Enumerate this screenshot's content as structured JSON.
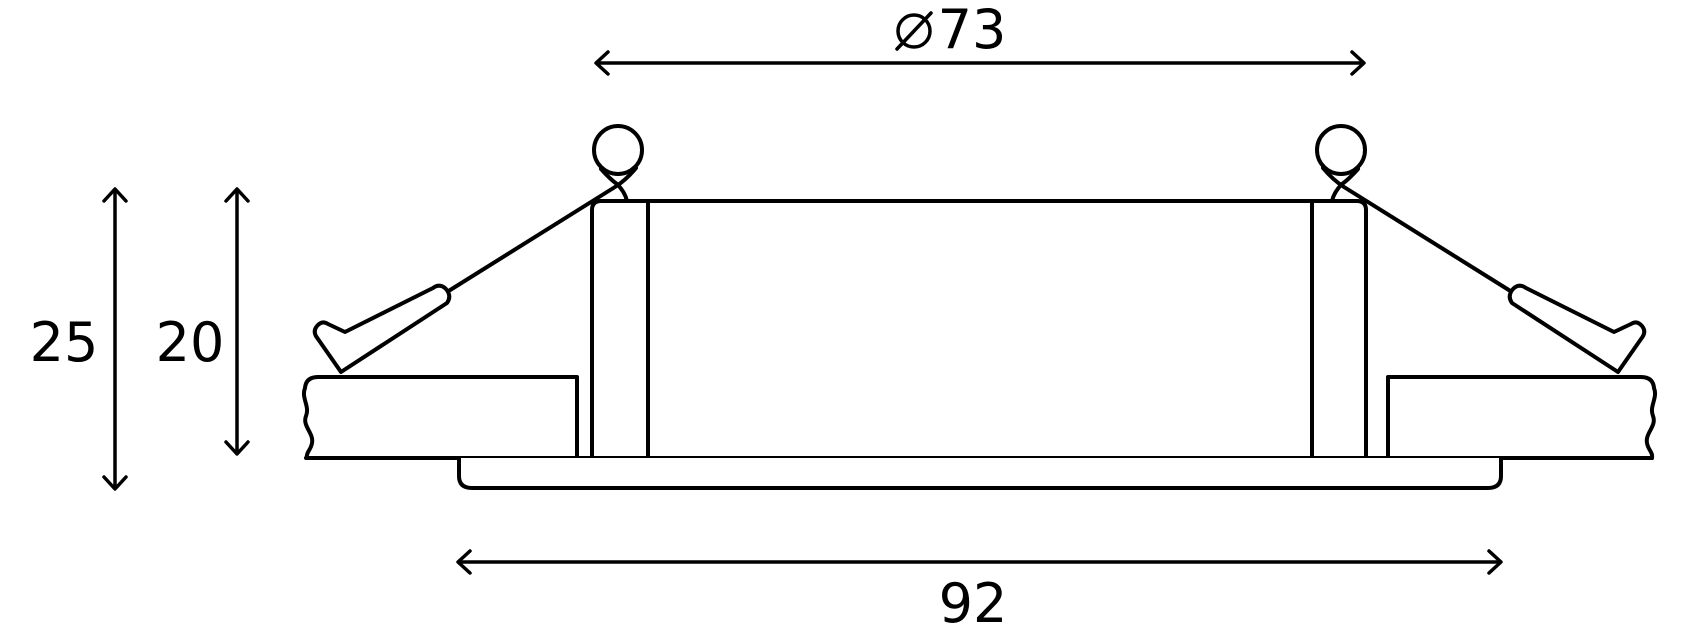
{
  "dimensions": {
    "diameter_top": {
      "symbol": "⌀",
      "value": "73"
    },
    "height_left_outer": {
      "value": "25"
    },
    "height_left_inner": {
      "value": "20"
    },
    "width_bottom": {
      "value": "92"
    }
  },
  "colors": {
    "line": "#000000",
    "background": "#ffffff"
  }
}
